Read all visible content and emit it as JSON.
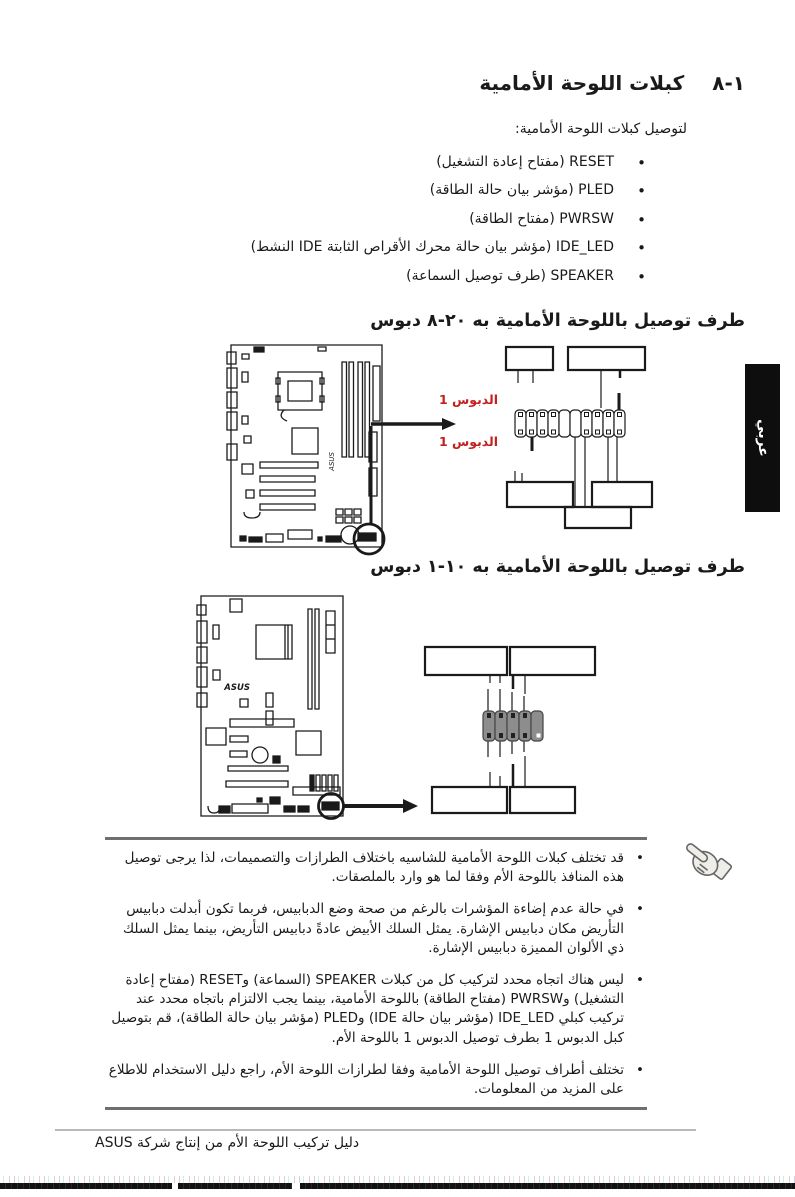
{
  "page": {
    "section_number": "١-٨",
    "title": "كبلات اللوحة الأمامية",
    "intro": "لتوصيل كبلات اللوحة الأمامية:",
    "cables": [
      "RESET (مفتاح إعادة التشغيل)",
      "PLED (مؤشر بيان حالة الطاقة)",
      "PWRSW (مفتاح الطاقة)",
      "IDE_LED (مؤشر بيان حالة محرك الأقراص الثابتة IDE النشط)",
      "SPEAKER (طرف توصيل السماعة)"
    ]
  },
  "figures": [
    {
      "heading": "طرف توصيل باللوحة الأمامية به ٢٠-٨ دبوس",
      "pin1_top": "الدبوس 1",
      "pin1_bottom": "الدبوس 1",
      "board_logo": "ASUS"
    },
    {
      "heading": "طرف توصيل باللوحة الأمامية به ١٠-١ دبوس",
      "board_logo": "ASUS"
    }
  ],
  "notes": [
    "قد تختلف كبلات اللوحة الأمامية للشاسيه باختلاف الطرازات والتصميمات، لذا يرجى توصيل هذه المنافذ باللوحة الأم وفقا لما هو وارد بالملصقات.",
    "في حالة عدم إضاءة المؤشرات بالرغم من صحة وضع الدبابيس، فربما تكون أبدلت دبابيس التأريض مكان دبابيس الإشارة. يمثل السلك الأبيض عادةً دبابيس التأريض، بينما يمثل السلك ذي الألوان المميزة دبابيس الإشارة.",
    "ليس هناك اتجاه محدد لتركيب كل من كبلات SPEAKER (السماعة) وRESET (مفتاح إعادة التشغيل) وPWRSW (مفتاح الطاقة) باللوحة الأمامية، بينما يجب الالتزام باتجاه محدد عند تركيب كبلي IDE_LED (مؤشر بيان حالة IDE) وPLED (مؤشر بيان حالة الطاقة)، قم بتوصيل كبل الدبوس 1 بطرف توصيل الدبوس 1 باللوحة الأم.",
    "تختلف أطراف توصيل اللوحة الأمامية وفقا لطرازات اللوحة الأم، راجع دليل الاستخدام للاطلاع على المزيد من المعلومات."
  ],
  "footer": "دليل تركيب اللوحة الأم من إنتاج شركة ASUS",
  "side_tab": "عربي",
  "colors": {
    "accent_red": "#c52020",
    "tab_black": "#0e0e0e",
    "text": "#1a1a1a",
    "pin_header_gray": "#8d8d8d"
  }
}
